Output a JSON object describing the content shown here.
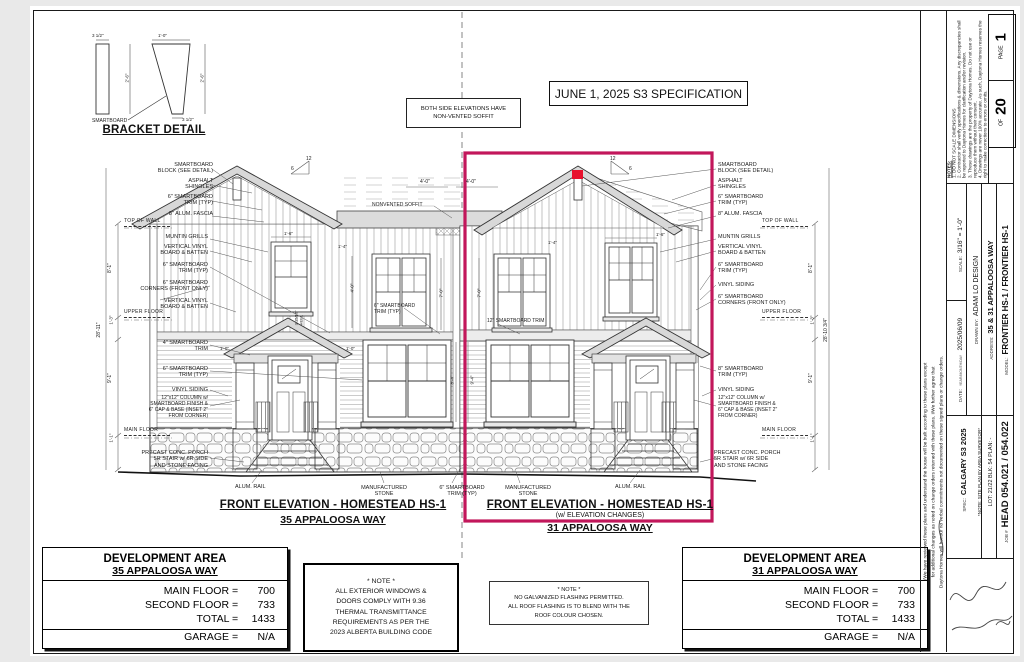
{
  "banner": {
    "spec_date": "JUNE 1, 2025 S3 SPECIFICATION"
  },
  "soffit_note": {
    "line1": "BOTH SIDE ELEVATIONS HAVE",
    "line2": "NON-VENTED SOFFIT"
  },
  "bracket_detail": {
    "title": "BRACKET DETAIL"
  },
  "elevations": {
    "left": {
      "title": "FRONT ELEVATION - HOMESTEAD HS-1",
      "subtitle": "",
      "address": "35 APPALOOSA WAY"
    },
    "right": {
      "title": "FRONT ELEVATION - HOMESTEAD HS-1",
      "subtitle": "(w/ ELEVATION CHANGES)",
      "address": "31 APPALOOSA WAY"
    }
  },
  "dev": {
    "left": {
      "title": "DEVELOPMENT AREA",
      "address": "35 APPALOOSA WAY",
      "rows": [
        {
          "label": "MAIN FLOOR =",
          "value": "700"
        },
        {
          "label": "SECOND FLOOR =",
          "value": "733"
        },
        {
          "label": "TOTAL =",
          "value": "1433"
        }
      ],
      "garage": {
        "label": "GARAGE =",
        "value": "N/A"
      }
    },
    "right": {
      "title": "DEVELOPMENT AREA",
      "address": "31 APPALOOSA WAY",
      "rows": [
        {
          "label": "MAIN FLOOR =",
          "value": "700"
        },
        {
          "label": "SECOND FLOOR =",
          "value": "733"
        },
        {
          "label": "TOTAL =",
          "value": "1433"
        }
      ],
      "garage": {
        "label": "GARAGE =",
        "value": "N/A"
      }
    }
  },
  "notes": {
    "thermal": [
      "* NOTE *",
      "ALL EXTERIOR WINDOWS &",
      "DOORS COMPLY WITH 9.36",
      "THERMAL TRANSMITTANCE",
      "REQUIREMENTS AS PER THE",
      "2023 ALBERTA BUILDING CODE"
    ],
    "flashing": [
      "* NOTE *",
      "NO GALVANIZED FLASHING PERMITTED.",
      "ALL ROOF FLASHING IS TO BLEND WITH THE",
      "ROOF COLOUR CHOSEN."
    ]
  },
  "tb": {
    "page": {
      "label": "PAGE",
      "num": "1",
      "of": "OF",
      "total": "20"
    },
    "notes_title": "NOTES:",
    "notes": [
      "1. DO NOT SCALE DIMENSIONS",
      "2. Contractor shall verify specifications & dimensions. Any discrepancies shall be reported to Daytona Homes for clarification and/or revision.",
      "3. These drawings are the property of Daytona Homes. Do not use or reproduce them without their consent.",
      "4. Drawings are never 100% accurate. As such, Daytona Homes reserves the right to make corrections to errors or omits."
    ],
    "model": {
      "label": "MODEL:",
      "value": "FRONTIER HS-1 / FRONTIER HS-1"
    },
    "address": {
      "label": "ADDRESS:",
      "value": "35  & 31 APPALOOSA WAY"
    },
    "drawn": {
      "label": "DRAWN BY:",
      "value": "ADAM LO DESIGN"
    },
    "date": {
      "label": "DATE:",
      "sub": "YEAR/MONTH/DAY",
      "value": "2025/06/09"
    },
    "scale": {
      "label": "SCALE:",
      "value": "3/16\" = 1'-0\""
    },
    "job": {
      "label": "JOB #",
      "value": "HEAD 054.021 / 054.022"
    },
    "lot": "LOT: 21/22   BLK: 54   PLAN: -",
    "site_note": "*NOTE: SITE PLAN BY AREA SURVEYOR*",
    "spec": {
      "label": "SPEC:",
      "value": "CALGARY S3 2025"
    },
    "disclaimer": [
      "I/We have reviewed these plans and understand the house will be built according to these plans except",
      "for additional changes as noted on change orders returned with these plans. I/We further agree that",
      "Daytona Homes will honour no verbal commitments not documented on these signed plans or change orders."
    ]
  },
  "colors": {
    "highlight": "#c2175b",
    "marker": "#e8112d"
  },
  "annotations": [
    {
      "t": "SMARTBOARD\nBLOCK (SEE DETAIL)",
      "x": 128,
      "y": 162,
      "w": 85,
      "a": "r"
    },
    {
      "t": "ASPHALT\nSHINGLES",
      "x": 148,
      "y": 178,
      "w": 65,
      "a": "r"
    },
    {
      "t": "6\" SMARTBOARD\nTRIM (TYP)",
      "x": 138,
      "y": 194,
      "w": 75,
      "a": "r"
    },
    {
      "t": "8\" ALUM. FASCIA",
      "x": 128,
      "y": 211,
      "w": 85,
      "a": "r"
    },
    {
      "t": "TOP OF WALL",
      "x": 124,
      "y": 219,
      "w": 46,
      "cls": "floor",
      "fs": 5
    },
    {
      "t": "MUNTIN GRILLS",
      "x": 128,
      "y": 234,
      "w": 80,
      "a": "r"
    },
    {
      "t": "VERTICAL VINYL\nBOARD & BATTEN",
      "x": 128,
      "y": 244,
      "w": 80,
      "a": "r"
    },
    {
      "t": "6\" SMARTBOARD\nTRIM (TYP)",
      "x": 138,
      "y": 262,
      "w": 70,
      "a": "r"
    },
    {
      "t": "6\" SMARTBOARD\nCORNERS (FRONT ONLY)",
      "x": 118,
      "y": 280,
      "w": 90,
      "a": "r"
    },
    {
      "t": "VERTICAL VINYL\nBOARD & BATTEN",
      "x": 128,
      "y": 298,
      "w": 80,
      "a": "r"
    },
    {
      "t": "UPPER FLOOR",
      "x": 124,
      "y": 310,
      "w": 46,
      "cls": "floor",
      "fs": 5
    },
    {
      "t": "4\" SMARTBOARD\nTRIM",
      "x": 138,
      "y": 340,
      "w": 70,
      "a": "r"
    },
    {
      "t": "6\" SMARTBOARD\nTRIM (TYP)",
      "x": 138,
      "y": 366,
      "w": 70,
      "a": "r"
    },
    {
      "t": "VINYL SIDING",
      "x": 138,
      "y": 387,
      "w": 70,
      "a": "r"
    },
    {
      "t": "12\"x12\" COLUMN w/\nSMARTBOARD FINISH &\n6\" CAP & BASE (INSET 2\"\nFROM CORNER)",
      "x": 112,
      "y": 396,
      "w": 96,
      "a": "r",
      "fs": 5
    },
    {
      "t": "MAIN FLOOR",
      "x": 124,
      "y": 428,
      "w": 46,
      "cls": "floor",
      "fs": 5
    },
    {
      "t": "PRECAST CONC. PORCH\n5R STAIR w/ 6R SIDE\nAND STONE FACING",
      "x": 112,
      "y": 450,
      "w": 96,
      "a": "r"
    },
    {
      "t": "SMARTBOARD\nBLOCK (SEE DETAIL)",
      "x": 718,
      "y": 162,
      "w": 85
    },
    {
      "t": "ASPHALT\nSHINGLES",
      "x": 718,
      "y": 178,
      "w": 65
    },
    {
      "t": "6\" SMARTBOARD\nTRIM (TYP)",
      "x": 718,
      "y": 194,
      "w": 75
    },
    {
      "t": "8\" ALUM. FASCIA",
      "x": 718,
      "y": 211,
      "w": 85
    },
    {
      "t": "TOP OF WALL",
      "x": 762,
      "y": 219,
      "w": 46,
      "cls": "floor",
      "fs": 5
    },
    {
      "t": "MUNTIN GRILLS",
      "x": 718,
      "y": 234,
      "w": 80
    },
    {
      "t": "VERTICAL VINYL\nBOARD & BATTEN",
      "x": 718,
      "y": 244,
      "w": 80
    },
    {
      "t": "6\" SMARTBOARD\nTRIM (TYP)",
      "x": 718,
      "y": 262,
      "w": 70
    },
    {
      "t": "VINYL SIDING",
      "x": 718,
      "y": 282,
      "w": 70
    },
    {
      "t": "6\" SMARTBOARD\nCORNERS (FRONT ONLY)",
      "x": 718,
      "y": 294,
      "w": 92
    },
    {
      "t": "UPPER FLOOR",
      "x": 762,
      "y": 310,
      "w": 46,
      "cls": "floor",
      "fs": 5
    },
    {
      "t": "8\" SMARTBOARD\nTRIM (TYP)",
      "x": 718,
      "y": 366,
      "w": 70
    },
    {
      "t": "VINYL SIDING",
      "x": 718,
      "y": 387,
      "w": 70
    },
    {
      "t": "12\"x12\" COLUMN w/\nSMARTBOARD FINISH &\n6\" CAP & BASE (INSET 2\"\nFROM CORNER)",
      "x": 718,
      "y": 396,
      "w": 96,
      "fs": 5
    },
    {
      "t": "MAIN FLOOR",
      "x": 762,
      "y": 428,
      "w": 46,
      "cls": "floor",
      "fs": 5
    },
    {
      "t": "PRECAST CONC. PORCH\n5R STAIR w/ 6R SIDE\nAND STONE FACING",
      "x": 714,
      "y": 450,
      "w": 96
    },
    {
      "t": "ALUM. RAIL",
      "x": 235,
      "y": 484,
      "w": 50
    },
    {
      "t": "MANUFACTURED\nSTONE",
      "x": 352,
      "y": 485,
      "w": 64,
      "a": "c"
    },
    {
      "t": "6\" SMARTBOARD\nTRIM (TYP)",
      "x": 430,
      "y": 485,
      "w": 64,
      "a": "c"
    },
    {
      "t": "MANUFACTURED\nSTONE",
      "x": 496,
      "y": 485,
      "w": 64,
      "a": "c"
    },
    {
      "t": "ALUM. RAIL",
      "x": 615,
      "y": 484,
      "w": 50
    },
    {
      "t": "NONVENTED SOFFIT",
      "x": 372,
      "y": 203,
      "w": 62,
      "fs": 5
    },
    {
      "t": "12\" SMARTBOARD TRIM",
      "x": 487,
      "y": 319,
      "w": 80,
      "fs": 5
    },
    {
      "t": "6\" SMARTBOARD\nTRIM (TYP)",
      "x": 374,
      "y": 304,
      "w": 60,
      "fs": 5
    },
    {
      "t": "4'-0\"",
      "x": 420,
      "y": 180,
      "fs": 5
    },
    {
      "t": "4'-0\"",
      "x": 466,
      "y": 180,
      "fs": 5
    },
    {
      "t": "12",
      "x": 306,
      "y": 157,
      "fs": 5
    },
    {
      "t": "6",
      "x": 291,
      "y": 167,
      "fs": 5
    },
    {
      "t": "12",
      "x": 610,
      "y": 157,
      "fs": 5
    },
    {
      "t": "6",
      "x": 629,
      "y": 167,
      "fs": 5
    },
    {
      "t": "1'-6\"",
      "x": 284,
      "y": 231,
      "fs": 4.5
    },
    {
      "t": "1'-6\"",
      "x": 656,
      "y": 232,
      "fs": 4.5
    },
    {
      "t": "1'-4\"",
      "x": 338,
      "y": 244,
      "fs": 4.5
    },
    {
      "t": "1'-4\"",
      "x": 548,
      "y": 240,
      "fs": 4.5
    },
    {
      "t": "4'-0\"",
      "x": 352,
      "y": 288,
      "rot": 1,
      "fs": 4.5
    },
    {
      "t": "7'-0\"",
      "x": 441,
      "y": 293,
      "rot": 1,
      "fs": 4.5
    },
    {
      "t": "7'-0\"",
      "x": 479,
      "y": 293,
      "rot": 1,
      "fs": 4.5
    },
    {
      "t": "8'-4\"",
      "x": 452,
      "y": 380,
      "rot": 1,
      "fs": 4.5
    },
    {
      "t": "9'-4\"",
      "x": 472,
      "y": 380,
      "rot": 1,
      "fs": 4.5
    },
    {
      "t": "1'-0\"",
      "x": 220,
      "y": 346,
      "fs": 4.5
    },
    {
      "t": "1'-0\"",
      "x": 346,
      "y": 346,
      "fs": 4.5
    },
    {
      "t": "3 15/16\"\nHEEL",
      "x": 299,
      "y": 318,
      "rot": 1,
      "fs": 4
    },
    {
      "t": "8'-1\"",
      "x": 111,
      "y": 268,
      "rot": 1,
      "fs": 5
    },
    {
      "t": "1'-3\"",
      "x": 111,
      "y": 320,
      "rot": 1,
      "fs": 4.5
    },
    {
      "t": "9'-1\"",
      "x": 111,
      "y": 378,
      "rot": 1,
      "fs": 5
    },
    {
      "t": "1'-1\"",
      "x": 111,
      "y": 438,
      "rot": 1,
      "fs": 4.5
    },
    {
      "t": "28'-11\"",
      "x": 100,
      "y": 330,
      "rot": 1,
      "fs": 5
    },
    {
      "t": "8'-1\"",
      "x": 812,
      "y": 268,
      "rot": 1,
      "fs": 5
    },
    {
      "t": "1'-3\"",
      "x": 812,
      "y": 320,
      "rot": 1,
      "fs": 4.5
    },
    {
      "t": "9'-1\"",
      "x": 812,
      "y": 378,
      "rot": 1,
      "fs": 5
    },
    {
      "t": "1'-1\"",
      "x": 812,
      "y": 438,
      "rot": 1,
      "fs": 4.5
    },
    {
      "t": "28'-10 3/4\"",
      "x": 827,
      "y": 330,
      "rot": 1,
      "fs": 5
    },
    {
      "t": "3 1/2\"",
      "x": 92,
      "y": 33,
      "fs": 4.5
    },
    {
      "t": "1'-0\"",
      "x": 158,
      "y": 33,
      "fs": 4.5
    },
    {
      "t": "2'-6\"",
      "x": 127,
      "y": 78,
      "rot": 1,
      "fs": 4.5
    },
    {
      "t": "2'-6\"",
      "x": 202,
      "y": 78,
      "rot": 1,
      "fs": 4.5
    },
    {
      "t": "3 1/2\"",
      "x": 182,
      "y": 117,
      "fs": 4.5
    },
    {
      "t": "SMARTBOARD",
      "x": 92,
      "y": 119,
      "fs": 5
    }
  ]
}
